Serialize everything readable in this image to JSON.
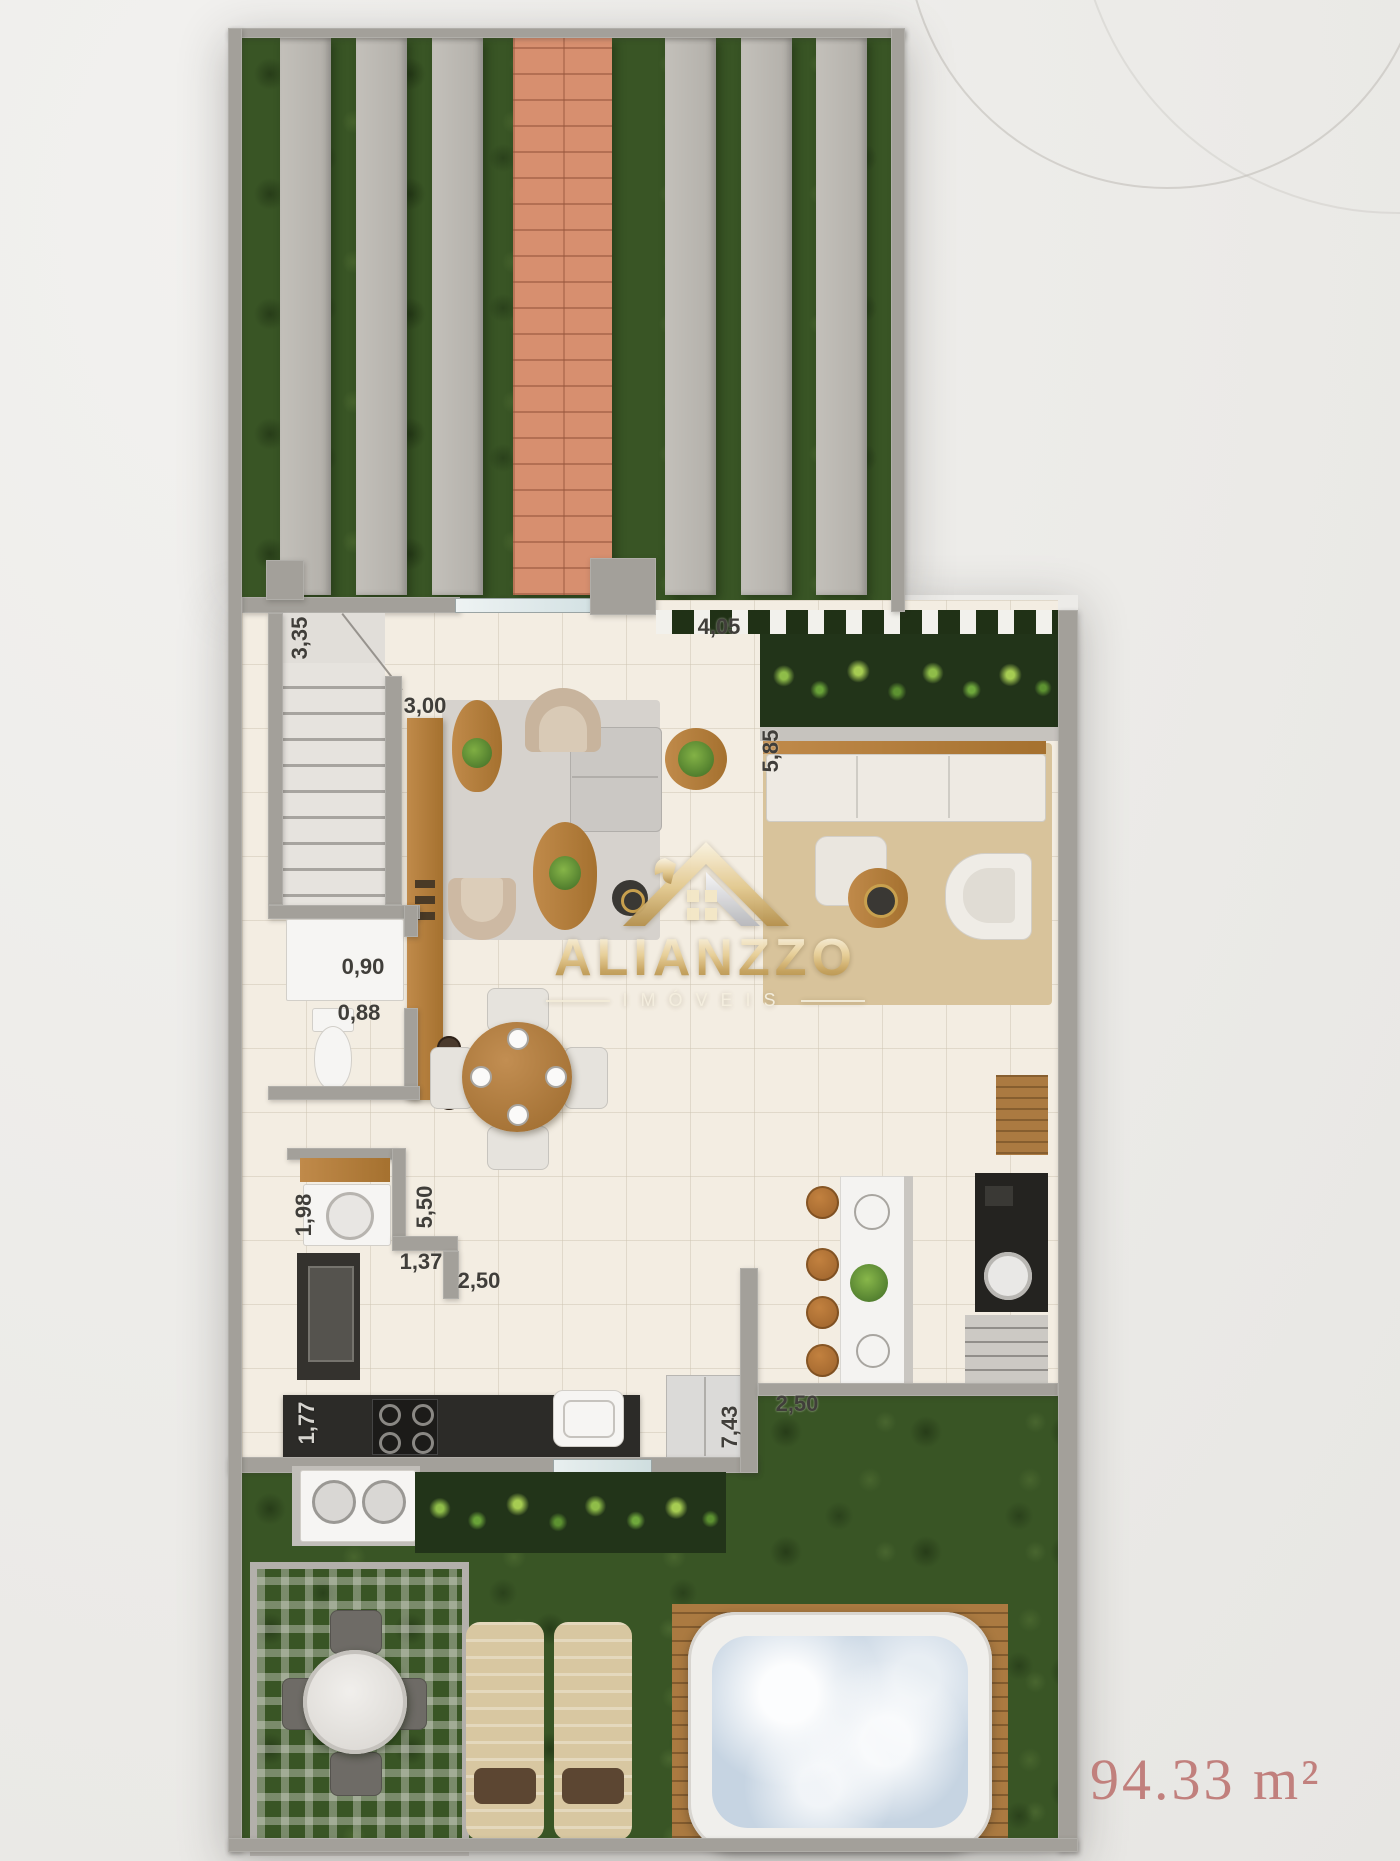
{
  "brand": {
    "name": "ALIANZZO",
    "tagline": "IMÓVEIS"
  },
  "area_label": "94.33 m²",
  "dimensions": [
    {
      "id": "stairs",
      "text": "3,35",
      "orientation": "vertical"
    },
    {
      "id": "living-top",
      "text": "3,00",
      "orientation": "horizontal"
    },
    {
      "id": "living-width",
      "text": "4,05",
      "orientation": "horizontal"
    },
    {
      "id": "tv-room-depth",
      "text": "5,85",
      "orientation": "vertical"
    },
    {
      "id": "bathroom-a",
      "text": "0,90",
      "orientation": "horizontal"
    },
    {
      "id": "bathroom-b",
      "text": "0,88",
      "orientation": "horizontal"
    },
    {
      "id": "laundry",
      "text": "1,98",
      "orientation": "vertical"
    },
    {
      "id": "kitchen-depth",
      "text": "5,50",
      "orientation": "vertical"
    },
    {
      "id": "hall",
      "text": "1,37",
      "orientation": "horizontal"
    },
    {
      "id": "dining",
      "text": "2,50",
      "orientation": "horizontal"
    },
    {
      "id": "counter",
      "text": "1,77",
      "orientation": "vertical"
    },
    {
      "id": "kitchen-run",
      "text": "7,43",
      "orientation": "vertical"
    },
    {
      "id": "terrace",
      "text": "2,50",
      "orientation": "horizontal"
    }
  ],
  "colors": {
    "grass": "#395525",
    "brick_path": "#d78f6f",
    "paver": "#b7b4ae",
    "wall": "#a3a09a",
    "floor": "#f3ede2",
    "logo_gold": "#d9bd8a",
    "area_text": "#c1807d",
    "counter_black": "#2c2b28",
    "wood": "#b5834a",
    "spa_water": "#c6d4e2"
  }
}
